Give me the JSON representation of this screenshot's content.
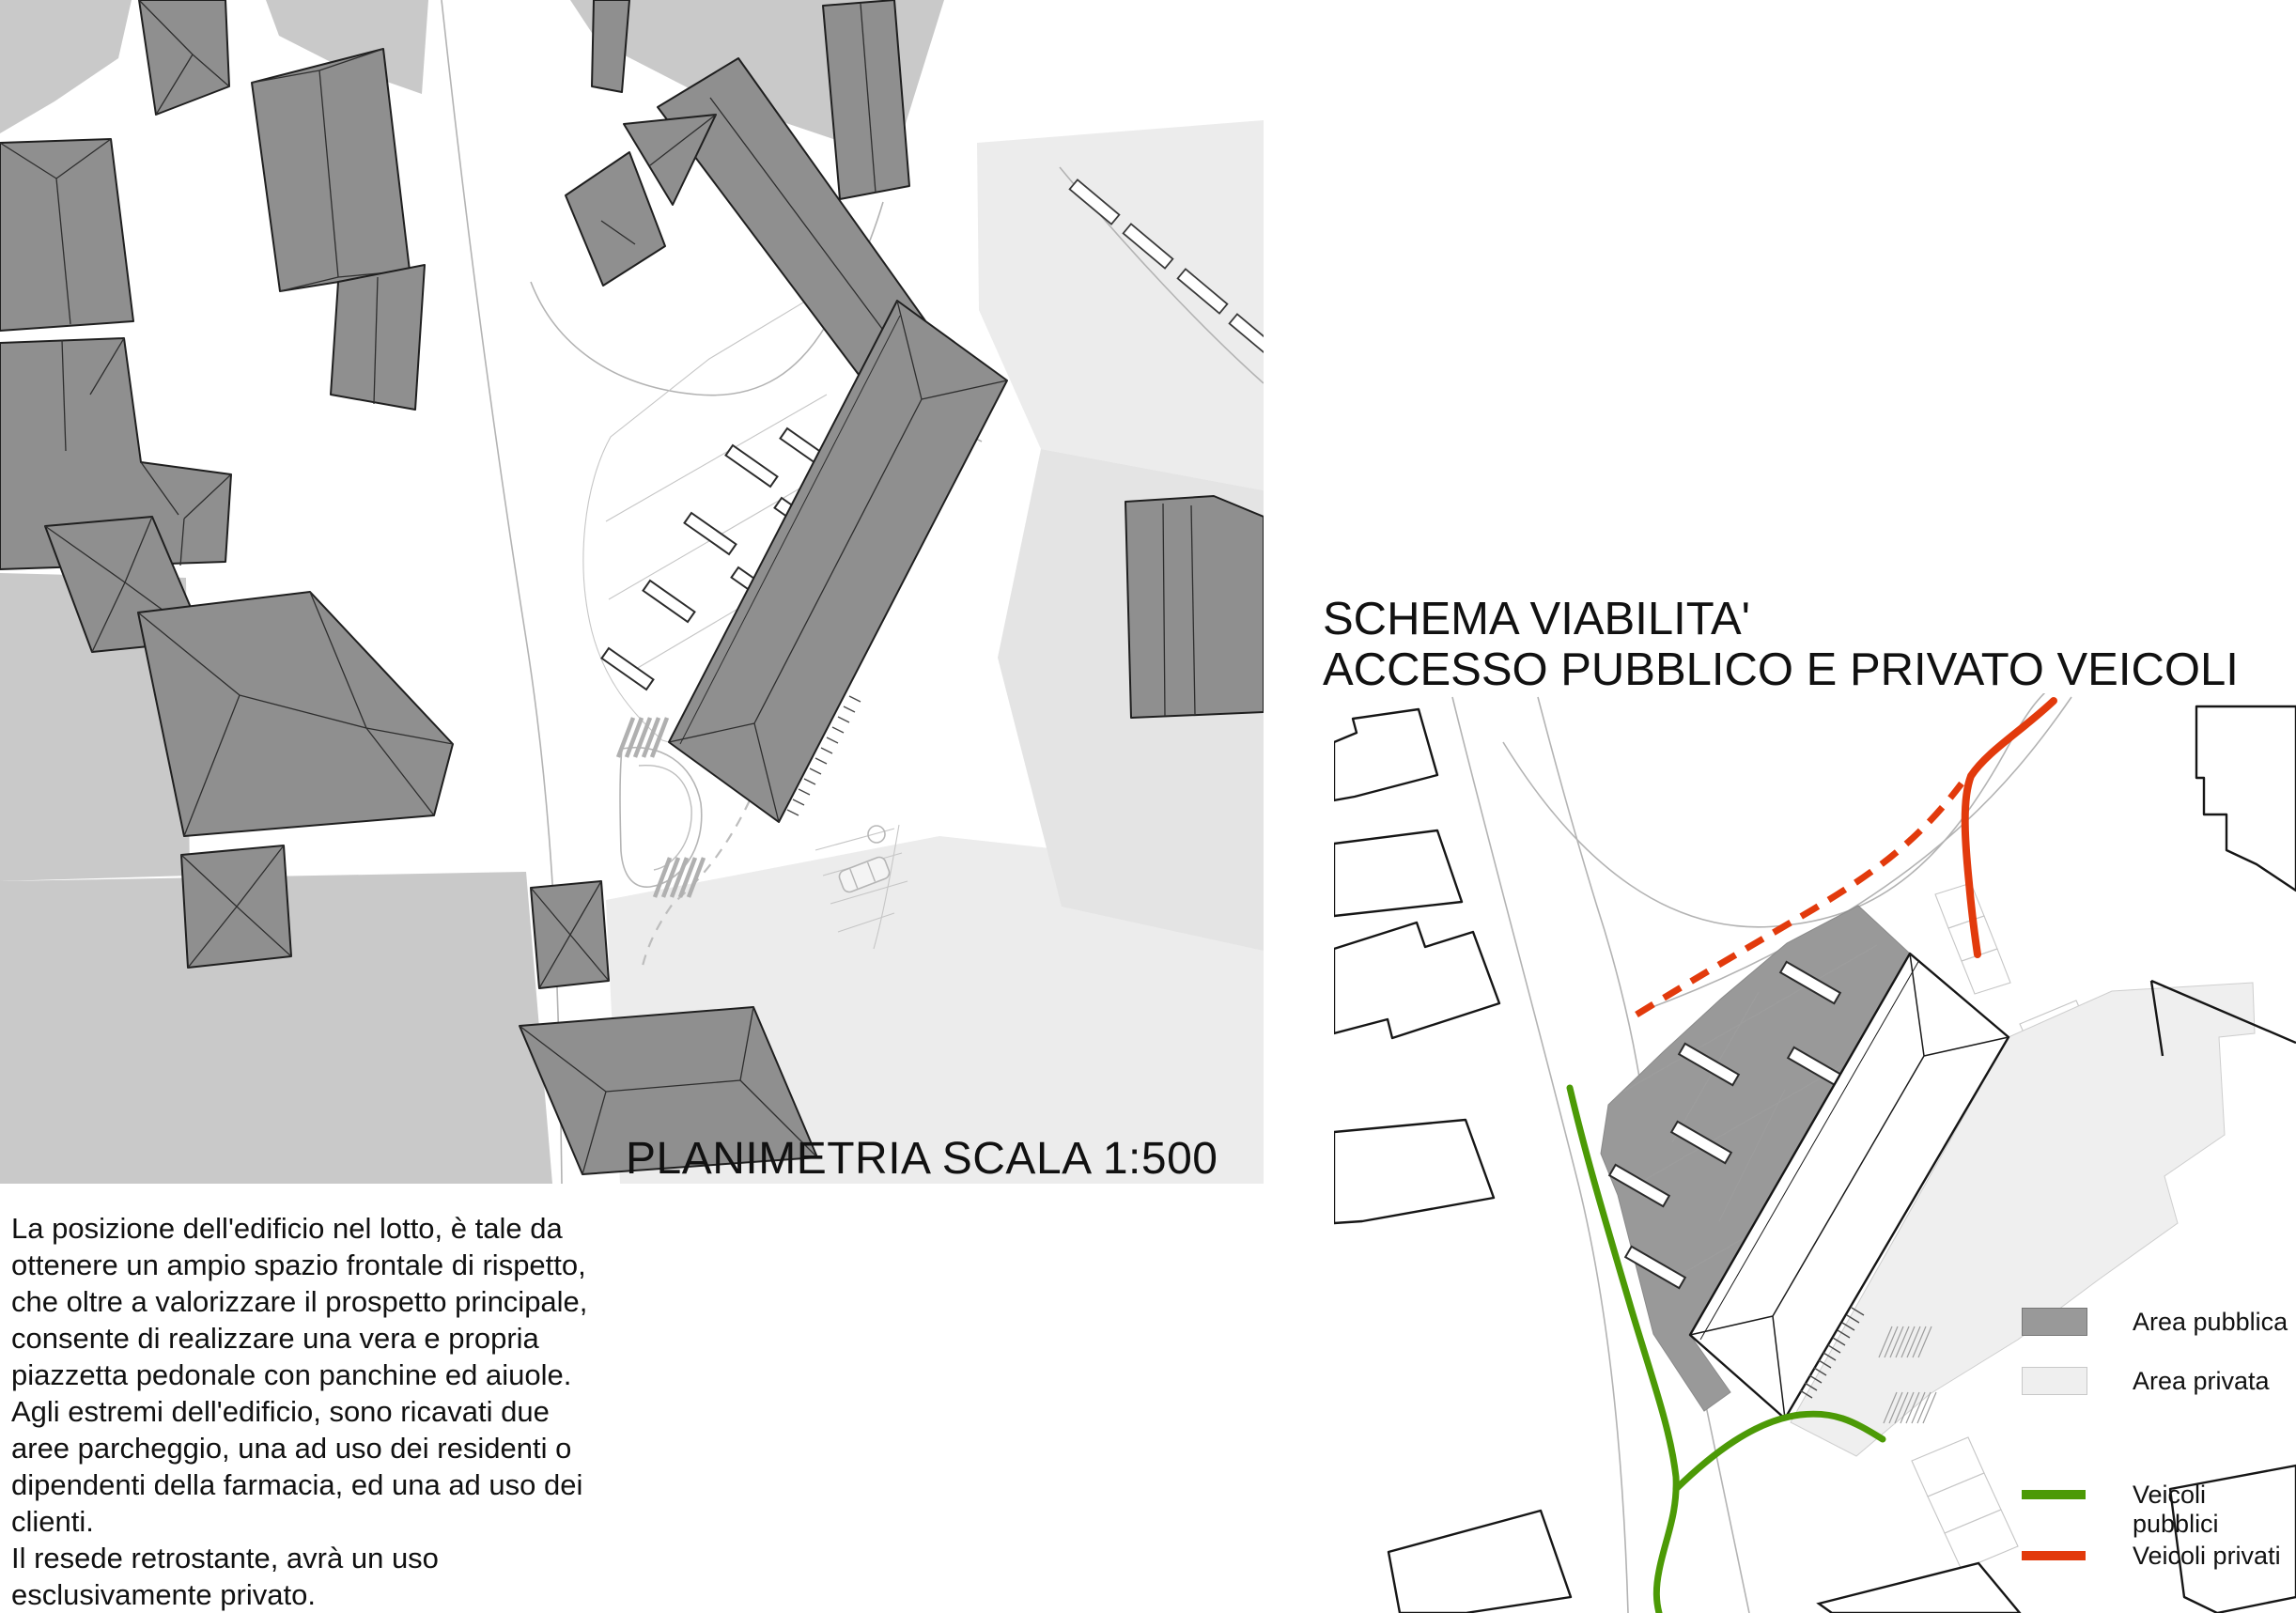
{
  "left_panel": {
    "caption": "PLANIMETRIA SCALA 1:500",
    "scale": "1:500",
    "description": "La posizione dell'edificio nel lotto, è tale da\nottenere un ampio spazio frontale di rispetto,\nche oltre a valorizzare il prospetto principale,\nconsente di realizzare una vera e propria\npiazzetta pedonale con panchine ed aiuole.\nAgli estremi dell'edificio, sono ricavati due\naree parcheggio, una ad uso dei residenti o\ndipendenti della farmacia, ed una ad uso dei\nclienti.\nIl resede retrostante, avrà un uso\nesclusivamente privato."
  },
  "right_panel": {
    "title_line1": "SCHEMA VIABILITA'",
    "title_line2": "ACCESSO PUBBLICO E PRIVATO VEICOLI",
    "legend": {
      "items": [
        {
          "label": "Area pubblica",
          "swatch": "area",
          "color": "#999999"
        },
        {
          "label": "Area privata",
          "swatch": "area",
          "color": "#efefef"
        },
        {
          "label": "Veicoli pubblici",
          "swatch": "line",
          "color": "#4c9a06"
        },
        {
          "label": "Veicoli privati",
          "swatch": "line",
          "color": "#e23a0c"
        }
      ]
    }
  },
  "colors": {
    "building": "#8f8f8f",
    "outline": "#1f1f1f",
    "patch_gray": "#c9c9c9",
    "patch_light": "#ececec",
    "patch_lighter": "#e4e4e4",
    "area_pubblica": "#999999",
    "area_privata": "#efefef",
    "veicoli_pubblici": "#4c9a06",
    "veicoli_privati": "#e23a0c"
  }
}
